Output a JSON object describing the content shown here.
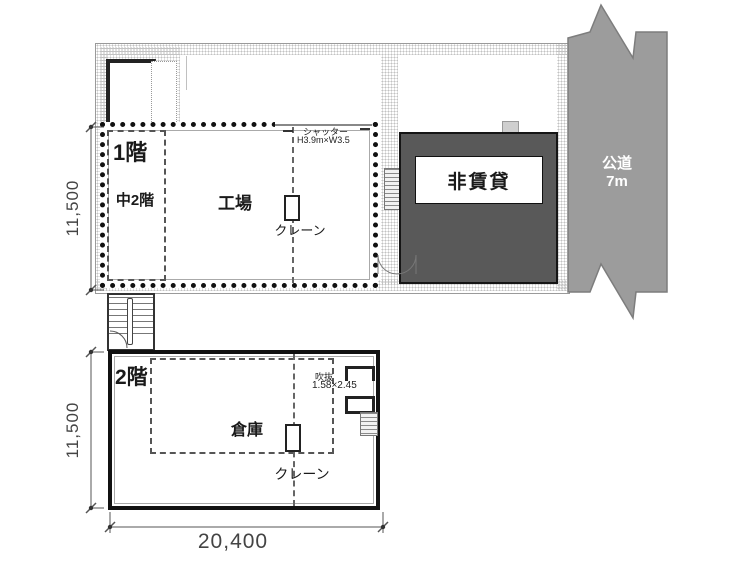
{
  "drawing_title": "factory-warehouse-floor-plan",
  "colors": {
    "background": "#ffffff",
    "wall": "#1a1a1a",
    "road_fill": "#9c9c9c",
    "road_stroke": "#7d7d7d",
    "non_rental_fill": "#595959",
    "dimension_text": "#444444"
  },
  "floor1": {
    "name_label": "1階",
    "mezzanine_label": "中2階",
    "room_label": "工場",
    "crane_label": "クレーン",
    "shutter": {
      "line1": "シャッター",
      "line2": "H3.9m×W3.5"
    }
  },
  "floor2": {
    "name_label": "2階",
    "room_label": "倉庫",
    "crane_label": "クレーン",
    "hoist_opening": {
      "line1": "吹抜",
      "line2": "1.58×2.45"
    }
  },
  "non_rental": {
    "label": "非賃貸"
  },
  "road": {
    "line1": "公道",
    "line2": "7m"
  },
  "dimensions": {
    "floor1_height": "11,500",
    "floor2_height": "11,500",
    "width": "20,400"
  }
}
